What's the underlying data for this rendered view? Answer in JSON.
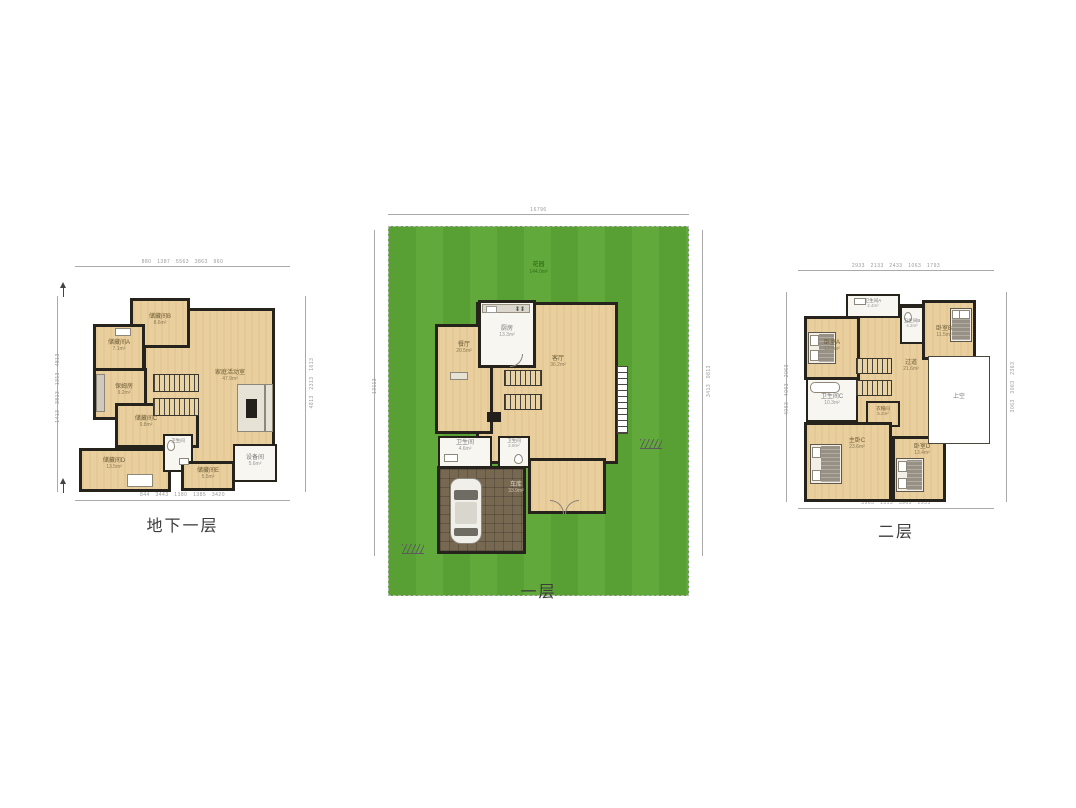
{
  "floors": {
    "basement": {
      "title": "地下一层",
      "rooms": {
        "family": {
          "name": "家庭活动室",
          "area": "47.9m²"
        },
        "storageB": {
          "name": "储藏间B",
          "area": "8.6m²"
        },
        "storageA": {
          "name": "储藏间A",
          "area": "7.1m²"
        },
        "nanny": {
          "name": "保姆房",
          "area": "9.2m²"
        },
        "storageC": {
          "name": "储藏间C",
          "area": "9.8m²"
        },
        "storageD": {
          "name": "储藏间D",
          "area": "13.5m²"
        },
        "bath": {
          "name": "卫生间",
          "area": "3.5m²"
        },
        "storageE": {
          "name": "储藏间E",
          "area": "5.5m²"
        },
        "equip": {
          "name": "设备间",
          "area": "5.6m²"
        }
      }
    },
    "first": {
      "title": "一层",
      "rooms": {
        "garden": {
          "name": "花园",
          "area": "144.0m²"
        },
        "dining": {
          "name": "餐厅",
          "area": "20.5m²"
        },
        "kitchen": {
          "name": "厨房",
          "area": "13.3m²"
        },
        "living": {
          "name": "客厅",
          "area": "36.2m²"
        },
        "bath1": {
          "name": "卫生间",
          "area": "4.6m²"
        },
        "bath2": {
          "name": "卫生间",
          "area": "2.8m²"
        },
        "garage": {
          "name": "车库",
          "area": "33.9m²"
        }
      }
    },
    "second": {
      "title": "二层",
      "rooms": {
        "bedA": {
          "name": "卧室A",
          "area": "13.9m²"
        },
        "bathA": {
          "name": "卫生间A",
          "area": "2.4m²"
        },
        "bathB": {
          "name": "卫生间B",
          "area": "4.2m²"
        },
        "bedB": {
          "name": "卧室B",
          "area": "11.5m²"
        },
        "corridor": {
          "name": "过道",
          "area": "21.6m²"
        },
        "bathC": {
          "name": "卫生间C",
          "area": "10.3m²"
        },
        "closet": {
          "name": "衣帽间",
          "area": "5.2m²"
        },
        "master": {
          "name": "主卧C",
          "area": "23.6m²"
        },
        "bedD": {
          "name": "卧室D",
          "area": "13.4m²"
        },
        "void": {
          "name": "上空",
          "area": ""
        }
      }
    }
  },
  "dims": {
    "basement": {
      "top": "880   1387   5563   3863   960",
      "bottom": "844   3443   1380   1385   3420",
      "left": "1413   3813   1313   4813",
      "right": "4813   2313   1613"
    },
    "first": {
      "top": "16796",
      "bottom": "1413   1980   4240   2980   5563",
      "left": "13113",
      "right": "3413   9813"
    },
    "second": {
      "top": "2933   2133   2433   1063   1793",
      "bottom": "3963   1313   3963   2933",
      "left": "4063   4063   2063",
      "right": "3063   3063   2363"
    }
  },
  "colors": {
    "wall": "#26231d",
    "room_tan": "#eacf9e",
    "room_white": "#f7f6f1",
    "garden_green": "#5ba135",
    "garage_floor": "#776852",
    "dim_grey": "#999999"
  }
}
